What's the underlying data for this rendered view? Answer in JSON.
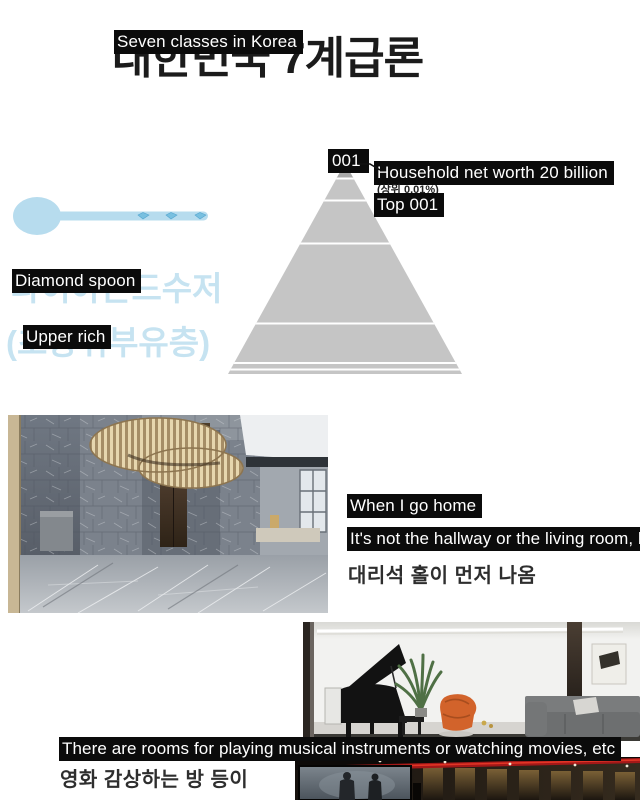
{
  "title": {
    "korean": "대한민국 7계급론",
    "overlay": "Seven classes in Korea"
  },
  "pyramid": {
    "levels": 7,
    "top_label": "001",
    "callout": {
      "line1": "Household net worth 20 billion",
      "korean_small": "(상위 0.01%)",
      "line2": "Top 001"
    }
  },
  "tier": {
    "spoon_overlay": "Diamond spoon",
    "spoon_korean": "다이아몬드수저",
    "rich_overlay": "Upper rich",
    "rich_korean": "(초상위부유층)"
  },
  "hall": {
    "caption1": "When I go home",
    "caption2": "It's not the hallway or the living room, b",
    "korean": "대리석 홀이 먼저 나옴"
  },
  "rooms": {
    "caption": "There are rooms for playing musical instruments or watching movies, etc",
    "korean": "영화 감상하는 방 등이"
  },
  "colors": {
    "accent_blue": "#b7dcee",
    "text_blue": "#c6e3f1",
    "pyramid_body": "#c5c5c5",
    "pyramid_tip": "#a8a8a8",
    "overlay_bg": "#0b0b0b",
    "overlay_text": "#ffffff"
  }
}
